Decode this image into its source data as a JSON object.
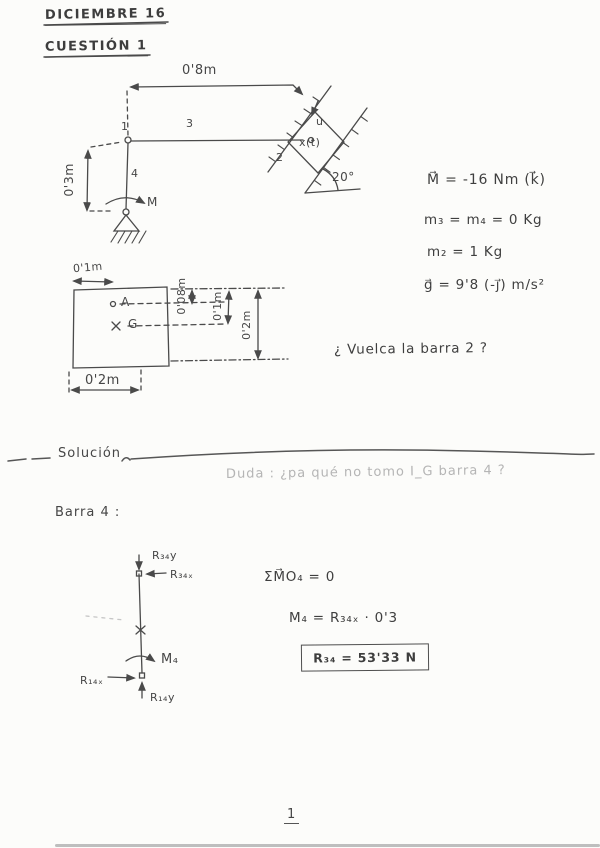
{
  "header": {
    "date": "DICIEMBRE 16",
    "question": "CUESTIÓN 1"
  },
  "diagram1": {
    "dim_top": "0'8m",
    "dim_left": "0'3m",
    "node1": "1",
    "bar3": "3",
    "bar4": "4",
    "moment": "M",
    "block": "2",
    "block_pos": "x(t)",
    "rail_dir": "u",
    "angle": "20°"
  },
  "given": {
    "moment": "M⃗ = -16 Nm  (k⃗)",
    "masses34": "m₃ = m₄ = 0 Kg",
    "mass2": "m₂ =  1 Kg",
    "gravity": "g⃗ =  9'8 (-j⃗)  m/s²",
    "question": "¿ Vuelca la barra 2 ?"
  },
  "diagram2": {
    "dim_top": "0'1m",
    "point_a": "A",
    "point_g": "G",
    "dim_right_small": "0'08m",
    "dim_right_mid": "0'1m",
    "dim_right_full": "0'2m",
    "dim_bottom": "0'2m"
  },
  "solution": {
    "title": "Solución",
    "faint_note": "Duda : ¿pa qué no tomo I_G barra 4 ?",
    "fbd_title": "Barra 4  :",
    "labels": {
      "r34y": "R₃₄y",
      "r34x": "R₃₄ₓ",
      "m4": "M₄",
      "r14x": "R₁₄ₓ",
      "r14y": "R₁₄y"
    },
    "eq_moments": "ΣM⃗O₄  = 0",
    "eq_m4": "M₄  =  R₃₄ₓ · 0'3",
    "result": "R₃₄ =  53'33 N"
  },
  "footer": {
    "page_number": "1"
  }
}
